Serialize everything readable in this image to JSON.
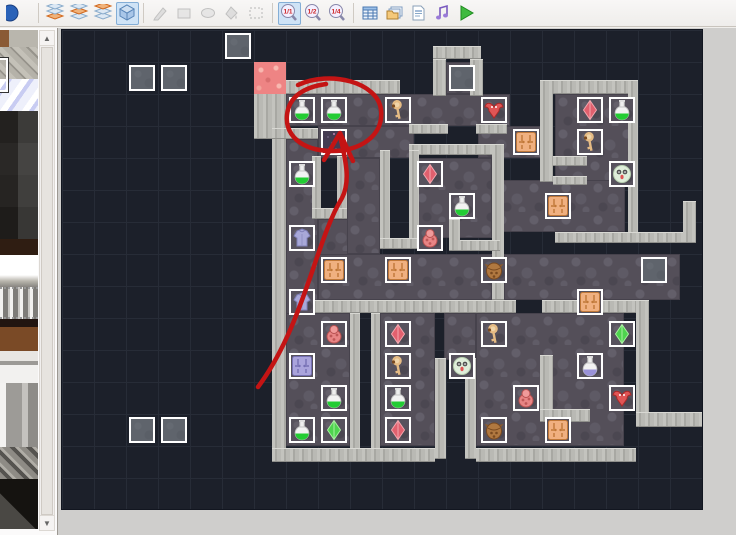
{
  "window": {
    "app": "map-editor"
  },
  "toolbar": {
    "zoom_labels": {
      "z11": "1/1",
      "z12": "1/2",
      "z14": "1/4"
    },
    "buttons": [
      {
        "name": "partial-icon",
        "icon": "halfsphere",
        "state": "normal",
        "interactable": true
      },
      {
        "name": "sep"
      },
      {
        "name": "layer-1-button",
        "icon": "layer1",
        "state": "normal",
        "interactable": true
      },
      {
        "name": "layer-2-button",
        "icon": "layer2",
        "state": "normal",
        "interactable": true
      },
      {
        "name": "layer-3-button",
        "icon": "layer3",
        "state": "normal",
        "interactable": true
      },
      {
        "name": "event-layer-button",
        "icon": "cube",
        "state": "selected",
        "interactable": true
      },
      {
        "name": "sep"
      },
      {
        "name": "pencil-button",
        "icon": "pencil",
        "state": "disabled",
        "interactable": true
      },
      {
        "name": "rectangle-button",
        "icon": "rect",
        "state": "disabled",
        "interactable": true
      },
      {
        "name": "ellipse-button",
        "icon": "ellipse",
        "state": "disabled",
        "interactable": true
      },
      {
        "name": "flood-fill-button",
        "icon": "fill",
        "state": "disabled",
        "interactable": true
      },
      {
        "name": "select-button",
        "icon": "select",
        "state": "disabled",
        "interactable": true
      },
      {
        "name": "sep"
      },
      {
        "name": "zoom-1-1-button",
        "icon": "zoom",
        "label_key": "z11",
        "state": "selected",
        "interactable": true
      },
      {
        "name": "zoom-1-2-button",
        "icon": "zoom",
        "label_key": "z12",
        "state": "normal",
        "interactable": true
      },
      {
        "name": "zoom-1-4-button",
        "icon": "zoom",
        "label_key": "z14",
        "state": "normal",
        "interactable": true
      },
      {
        "name": "sep"
      },
      {
        "name": "database-button",
        "icon": "database",
        "state": "normal",
        "interactable": true
      },
      {
        "name": "materials-button",
        "icon": "materials",
        "state": "normal",
        "interactable": true
      },
      {
        "name": "script-editor-button",
        "icon": "script",
        "state": "normal",
        "interactable": true
      },
      {
        "name": "audio-button",
        "icon": "audio",
        "state": "normal",
        "interactable": true
      },
      {
        "name": "playtest-button",
        "icon": "play",
        "state": "normal",
        "interactable": true
      }
    ]
  },
  "palette": {
    "tiles": [
      {
        "name": "tile-stone-partial",
        "cls": "t-stonepart"
      },
      {
        "name": "tile-rubble",
        "cls": "t-rubble"
      },
      {
        "name": "tile-ice",
        "cls": "t-ice"
      },
      {
        "name": "tile-dark-brick-1",
        "cls": "t-brick1"
      },
      {
        "name": "tile-dark-brick-2",
        "cls": "t-brick2"
      },
      {
        "name": "tile-dark-brick-3",
        "cls": "t-brick3"
      },
      {
        "name": "tile-dark-brick-4",
        "cls": "t-brick4"
      },
      {
        "name": "tile-brown-strip",
        "cls": "t-brown"
      },
      {
        "name": "tile-white-block",
        "cls": "t-white"
      },
      {
        "name": "tile-bars",
        "cls": "t-bars"
      },
      {
        "name": "tile-shelf",
        "cls": "t-shelf"
      },
      {
        "name": "tile-pillar-top",
        "cls": "t-pillartop"
      },
      {
        "name": "tile-pillar-shaft",
        "cls": "t-pillar"
      },
      {
        "name": "tile-ramp",
        "cls": "t-ramp"
      },
      {
        "name": "tile-dark-triangle",
        "cls": "t-darktri"
      }
    ],
    "scrollbar": {
      "up": "▲",
      "down": "▼"
    }
  },
  "map": {
    "tile_size": 32,
    "cols": 20,
    "rows": 15,
    "colors": {
      "bg": "#1c202a",
      "grid": "#272c37",
      "floor": "#544f59",
      "wall": "#b9b9b4",
      "event_fill": "#5f646c",
      "painted": "#ee8484",
      "annotation": "#c41414"
    },
    "floors": [
      [
        12,
        1,
        1,
        1
      ],
      [
        7,
        2,
        7,
        1
      ],
      [
        8,
        3,
        3,
        1
      ],
      [
        13,
        3,
        2,
        1
      ],
      [
        15.4,
        2,
        2.45,
        2.75
      ],
      [
        11,
        4,
        2.45,
        2.5
      ],
      [
        7,
        3.4,
        1,
        9.6
      ],
      [
        8,
        5.9,
        1,
        2.1
      ],
      [
        8.9,
        4,
        1.05,
        3
      ],
      [
        13.5,
        4.7,
        4.1,
        1.6
      ],
      [
        8,
        7,
        5.45,
        1.45
      ],
      [
        13.8,
        7,
        5.5,
        1.45
      ],
      [
        7,
        8.85,
        2,
        4.15
      ],
      [
        9.95,
        8.85,
        1.7,
        4.15
      ],
      [
        12.95,
        8.85,
        4.6,
        4.15
      ],
      [
        11.95,
        8.85,
        1,
        1.45
      ]
    ],
    "walls": [
      [
        11.6,
        0.5,
        1.5,
        0.4
      ],
      [
        11.6,
        0.9,
        0.4,
        1.15
      ],
      [
        12.75,
        0.9,
        0.4,
        1.15
      ],
      [
        7,
        1.55,
        3.55,
        0.45
      ],
      [
        6,
        1.95,
        0.6,
        1.45
      ],
      [
        6.55,
        1.95,
        0.45,
        11.55
      ],
      [
        6.55,
        3.05,
        1.45,
        0.35
      ],
      [
        7.8,
        3.95,
        0.3,
        1.95
      ],
      [
        8.6,
        3.95,
        0.3,
        1.95
      ],
      [
        7.8,
        5.55,
        1.1,
        0.35
      ],
      [
        10.85,
        2.95,
        1.2,
        0.3
      ],
      [
        12.95,
        2.95,
        0.95,
        0.3
      ],
      [
        10.85,
        3.55,
        2.9,
        0.35
      ],
      [
        9.95,
        3.75,
        0.3,
        3.1
      ],
      [
        10.85,
        3.75,
        0.3,
        3.1
      ],
      [
        9.95,
        6.5,
        1.2,
        0.35
      ],
      [
        13.45,
        3.55,
        0.35,
        4.9
      ],
      [
        12.1,
        6.55,
        1.6,
        0.35
      ],
      [
        12.1,
        5.9,
        0.35,
        1
      ],
      [
        15.35,
        3.95,
        1.05,
        0.3
      ],
      [
        15.35,
        4.55,
        1.05,
        0.3
      ],
      [
        14.95,
        1.55,
        3.05,
        0.45
      ],
      [
        14.95,
        1.55,
        0.4,
        3.2
      ],
      [
        17.7,
        1.55,
        0.3,
        4.85
      ],
      [
        15.4,
        6.3,
        4,
        0.35
      ],
      [
        19.4,
        5.35,
        0.4,
        1.3
      ],
      [
        7.5,
        8.45,
        6.7,
        0.4
      ],
      [
        15,
        8.45,
        3,
        0.4
      ],
      [
        9,
        8.85,
        0.3,
        4.5
      ],
      [
        9.65,
        8.85,
        0.3,
        4.5
      ],
      [
        11.65,
        10.25,
        0.35,
        3.15
      ],
      [
        12.6,
        10.25,
        0.35,
        3.15
      ],
      [
        14.95,
        10.15,
        0.4,
        1.75
      ],
      [
        14.95,
        11.85,
        1.55,
        0.4
      ],
      [
        17.95,
        8.45,
        0.4,
        3.55
      ],
      [
        17.95,
        11.95,
        2.05,
        0.45
      ],
      [
        6.55,
        13.05,
        5.1,
        0.45
      ],
      [
        12.95,
        13.05,
        5,
        0.45
      ]
    ],
    "gray_events": [
      [
        5,
        0
      ],
      [
        2,
        1
      ],
      [
        3,
        1
      ],
      [
        12,
        1
      ],
      [
        18,
        7
      ],
      [
        2,
        12
      ],
      [
        3,
        12
      ]
    ],
    "painted_tiles": [
      {
        "type": "pink-tile",
        "pos": [
          6,
          1
        ]
      }
    ],
    "items": [
      {
        "type": "potion-green",
        "pos": [
          7,
          2
        ]
      },
      {
        "type": "potion-green",
        "pos": [
          8,
          2
        ]
      },
      {
        "type": "key",
        "pos": [
          10,
          2
        ]
      },
      {
        "type": "bat-red",
        "pos": [
          13,
          2
        ]
      },
      {
        "type": "crystal-red",
        "pos": [
          16,
          2
        ]
      },
      {
        "type": "potion-green",
        "pos": [
          17,
          2
        ]
      },
      {
        "type": "dark-tile",
        "pos": [
          8,
          3
        ]
      },
      {
        "type": "rug-orange",
        "pos": [
          14,
          3
        ]
      },
      {
        "type": "key",
        "pos": [
          16,
          3
        ]
      },
      {
        "type": "potion-green",
        "pos": [
          7,
          4
        ]
      },
      {
        "type": "crystal-red",
        "pos": [
          11,
          4
        ]
      },
      {
        "type": "ghost",
        "pos": [
          17,
          4
        ]
      },
      {
        "type": "potion-green",
        "pos": [
          12,
          5
        ]
      },
      {
        "type": "rug-orange",
        "pos": [
          15,
          5
        ]
      },
      {
        "type": "armor",
        "pos": [
          7,
          6
        ]
      },
      {
        "type": "imp-pink",
        "pos": [
          11,
          6
        ]
      },
      {
        "type": "rug-orange",
        "pos": [
          8,
          7
        ]
      },
      {
        "type": "rug-orange",
        "pos": [
          10,
          7
        ]
      },
      {
        "type": "owl-brown",
        "pos": [
          13,
          7
        ]
      },
      {
        "type": "armor",
        "pos": [
          7,
          8
        ]
      },
      {
        "type": "rug-orange",
        "pos": [
          16,
          8
        ]
      },
      {
        "type": "imp-pink",
        "pos": [
          8,
          9
        ]
      },
      {
        "type": "crystal-red",
        "pos": [
          10,
          9
        ]
      },
      {
        "type": "key",
        "pos": [
          13,
          9
        ]
      },
      {
        "type": "crystal-green",
        "pos": [
          17,
          9
        ]
      },
      {
        "type": "rug-blue",
        "pos": [
          7,
          10
        ]
      },
      {
        "type": "key",
        "pos": [
          10,
          10
        ]
      },
      {
        "type": "ghost",
        "pos": [
          12,
          10
        ]
      },
      {
        "type": "potion-blue",
        "pos": [
          16,
          10
        ]
      },
      {
        "type": "potion-green",
        "pos": [
          8,
          11
        ]
      },
      {
        "type": "potion-green",
        "pos": [
          10,
          11
        ]
      },
      {
        "type": "imp-pink",
        "pos": [
          14,
          11
        ]
      },
      {
        "type": "bat-red",
        "pos": [
          17,
          11
        ]
      },
      {
        "type": "potion-green",
        "pos": [
          7,
          12
        ]
      },
      {
        "type": "crystal-green",
        "pos": [
          8,
          12
        ]
      },
      {
        "type": "crystal-red",
        "pos": [
          10,
          12
        ]
      },
      {
        "type": "owl-brown",
        "pos": [
          13,
          12
        ]
      },
      {
        "type": "rug-orange",
        "pos": [
          15,
          12
        ]
      }
    ],
    "annotation": {
      "color": "#c41414",
      "width": 4.5,
      "circle_path": "M 240,57 C 272,42 320,54 323,82 C 326,108 301,124 272,123 C 243,122 227,107 229,87 C 231,68 247,59 268,56",
      "arrow_shaft": "M 200,359 C 246,297 258,212 284,170 C 293,153 287,130 283,112",
      "arrow_head": "M 266,132 L 282,105 L 295,133"
    }
  }
}
